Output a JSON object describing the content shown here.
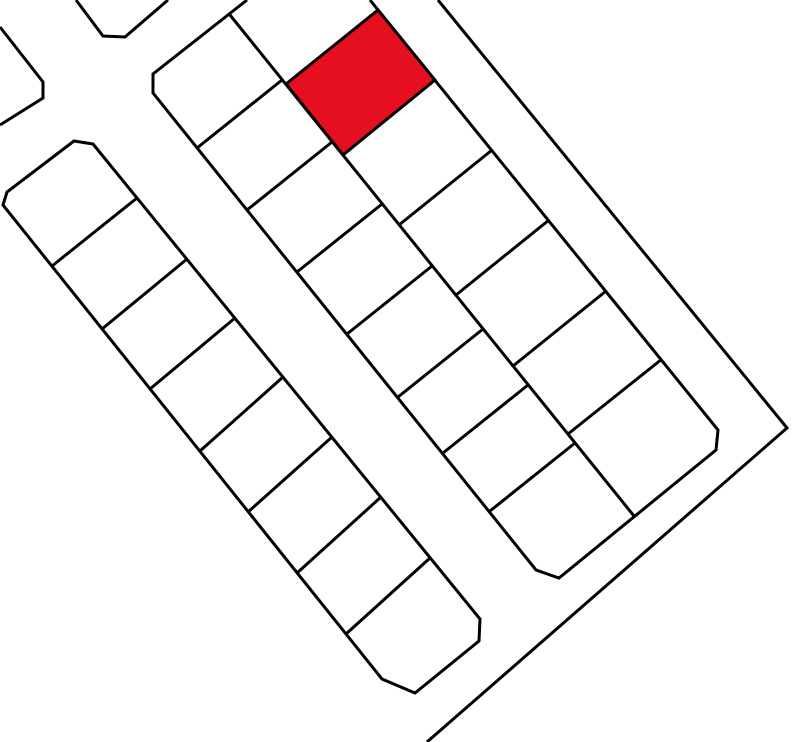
{
  "canvas": {
    "width": 800,
    "height": 742,
    "background": "#ffffff"
  },
  "map": {
    "stroke_color": "#000000",
    "stroke_width": 3,
    "highlight_color": "#e60f1f",
    "shapes": [
      {
        "name": "block-northwest-corner-outline",
        "type": "polyline",
        "points": [
          [
            0,
            27
          ],
          [
            43,
            82
          ],
          [
            43,
            98
          ],
          [
            0,
            125
          ]
        ]
      },
      {
        "name": "block-north-corner-outline",
        "type": "polyline",
        "points": [
          [
            76,
            0
          ],
          [
            103,
            36
          ],
          [
            125,
            37
          ],
          [
            168,
            0
          ]
        ]
      },
      {
        "name": "block-left-outline",
        "type": "polygon",
        "points": [
          [
            93,
            144
          ],
          [
            480,
            619
          ],
          [
            479,
            641
          ],
          [
            415,
            693
          ],
          [
            382,
            679
          ],
          [
            3,
            205
          ],
          [
            7,
            192
          ],
          [
            74,
            141
          ]
        ]
      },
      {
        "name": "block-left-lot-line-1",
        "type": "polyline",
        "points": [
          [
            52,
            266
          ],
          [
            137,
            198
          ]
        ]
      },
      {
        "name": "block-left-lot-line-2",
        "type": "polyline",
        "points": [
          [
            102,
            329
          ],
          [
            187,
            259
          ]
        ]
      },
      {
        "name": "block-left-lot-line-3",
        "type": "polyline",
        "points": [
          [
            150,
            389
          ],
          [
            235,
            318
          ]
        ]
      },
      {
        "name": "block-left-lot-line-4",
        "type": "polyline",
        "points": [
          [
            200,
            451
          ],
          [
            283,
            377
          ]
        ]
      },
      {
        "name": "block-left-lot-line-5",
        "type": "polyline",
        "points": [
          [
            248,
            512
          ],
          [
            332,
            437
          ]
        ]
      },
      {
        "name": "block-left-lot-line-6",
        "type": "polyline",
        "points": [
          [
            297,
            573
          ],
          [
            381,
            497
          ]
        ]
      },
      {
        "name": "block-left-lot-line-7",
        "type": "polyline",
        "points": [
          [
            346,
            634
          ],
          [
            430,
            558
          ]
        ]
      },
      {
        "name": "block-middle-outline",
        "type": "polyline",
        "points": [
          [
            247,
            0
          ],
          [
            153,
            74
          ],
          [
            153,
            93
          ],
          [
            536,
            570
          ],
          [
            559,
            578
          ],
          [
            716,
            450
          ],
          [
            718,
            430
          ],
          [
            370,
            0
          ]
        ]
      },
      {
        "name": "block-middle-center-line",
        "type": "polyline",
        "points": [
          [
            230,
            15
          ],
          [
            634,
            516
          ]
        ]
      },
      {
        "name": "block-middle-west-lot-line-1",
        "type": "polyline",
        "points": [
          [
            197,
            148
          ],
          [
            282,
            80
          ]
        ]
      },
      {
        "name": "block-middle-west-lot-line-2",
        "type": "polyline",
        "points": [
          [
            247,
            210
          ],
          [
            332,
            142
          ]
        ]
      },
      {
        "name": "block-middle-west-lot-line-3",
        "type": "polyline",
        "points": [
          [
            297,
            272
          ],
          [
            382,
            204
          ]
        ]
      },
      {
        "name": "block-middle-west-lot-line-4",
        "type": "polyline",
        "points": [
          [
            347,
            334
          ],
          [
            432,
            266
          ]
        ]
      },
      {
        "name": "block-middle-west-lot-line-5",
        "type": "polyline",
        "points": [
          [
            398,
            397
          ],
          [
            483,
            329
          ]
        ]
      },
      {
        "name": "block-middle-west-lot-line-6",
        "type": "polyline",
        "points": [
          [
            443,
            453
          ],
          [
            528,
            385
          ]
        ]
      },
      {
        "name": "block-middle-west-lot-line-7",
        "type": "polyline",
        "points": [
          [
            490,
            511
          ],
          [
            575,
            443
          ]
        ]
      },
      {
        "name": "block-middle-east-lot-line-1",
        "type": "polyline",
        "points": [
          [
            492,
            150
          ],
          [
            399,
            225
          ]
        ]
      },
      {
        "name": "block-middle-east-lot-line-2",
        "type": "polyline",
        "points": [
          [
            549,
            220
          ],
          [
            456,
            295
          ]
        ]
      },
      {
        "name": "block-middle-east-lot-line-3",
        "type": "polyline",
        "points": [
          [
            606,
            291
          ],
          [
            513,
            366
          ]
        ]
      },
      {
        "name": "block-middle-east-lot-line-4",
        "type": "polyline",
        "points": [
          [
            662,
            359
          ],
          [
            568,
            434
          ]
        ]
      },
      {
        "name": "highlighted-parcel",
        "type": "polygon",
        "points": [
          [
            378,
            10
          ],
          [
            435,
            80
          ],
          [
            343,
            155
          ],
          [
            286,
            84
          ]
        ],
        "fill": "#e60f1f"
      },
      {
        "name": "street-boundary-east",
        "type": "polyline",
        "points": [
          [
            438,
            0
          ],
          [
            787,
            428
          ],
          [
            427,
            742
          ]
        ]
      }
    ]
  }
}
